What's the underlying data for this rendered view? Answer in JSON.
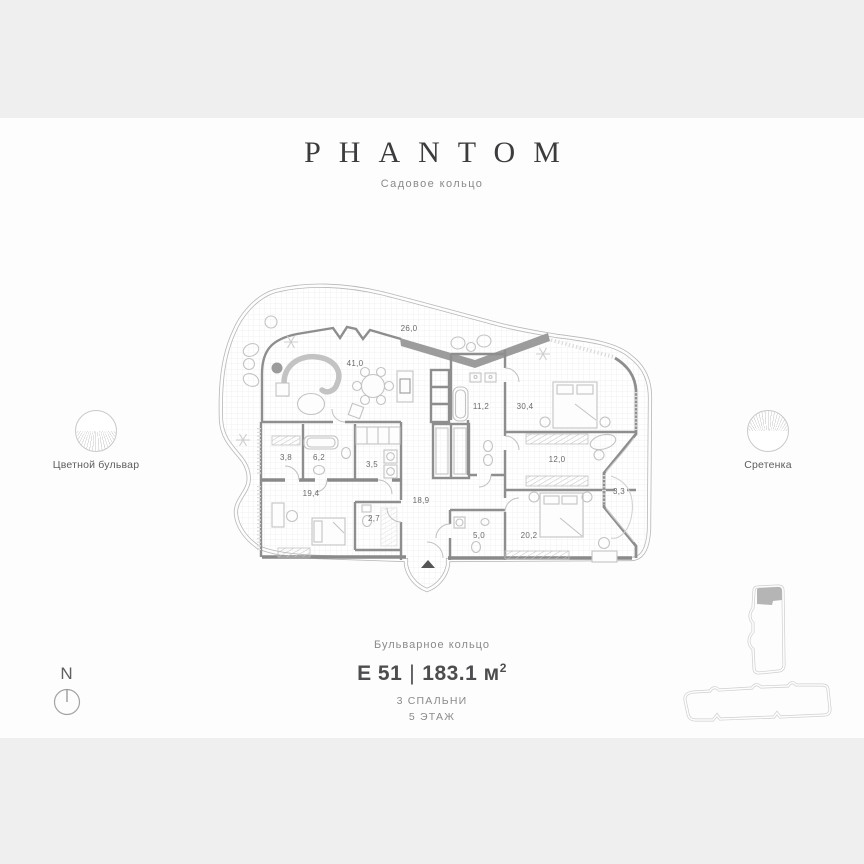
{
  "colors": {
    "background": "#efefef",
    "canvas": "#fdfdfd",
    "wall": "#8e8e8e",
    "text_dark": "#3c3c3e",
    "text_muted": "#8a8a8a"
  },
  "header": {
    "title": "PHANTOM",
    "subtitle": "Садовое кольцо"
  },
  "landmarks": {
    "left": {
      "label": "Цветной бульвар"
    },
    "right": {
      "label": "Сретенка"
    }
  },
  "footer": {
    "street": "Бульварное кольцо",
    "unit": "Е 51",
    "sep": "|",
    "area": "183.1",
    "area_unit": "м",
    "area_sup": "2",
    "bedrooms": "3 СПАЛЬНИ",
    "floor": "5 ЭТАЖ"
  },
  "compass": {
    "label": "N"
  },
  "floor_plan": {
    "total_area_m2": "183.1",
    "rooms": [
      {
        "name": "terrace",
        "area": "26,0",
        "x": 194,
        "y": 61
      },
      {
        "name": "living-room",
        "area": "41,0",
        "x": 140,
        "y": 96
      },
      {
        "name": "bathroom-main",
        "area": "11,2",
        "x": 266,
        "y": 139
      },
      {
        "name": "master-bedroom",
        "area": "30,4",
        "x": 310,
        "y": 139
      },
      {
        "name": "wardrobe-small",
        "area": "3,8",
        "x": 71,
        "y": 190
      },
      {
        "name": "bathroom-2",
        "area": "6,2",
        "x": 104,
        "y": 190
      },
      {
        "name": "laundry",
        "area": "3,5",
        "x": 157,
        "y": 197
      },
      {
        "name": "dressing-room",
        "area": "12,0",
        "x": 342,
        "y": 192
      },
      {
        "name": "bedroom-2",
        "area": "19,4",
        "x": 96,
        "y": 226
      },
      {
        "name": "hallway",
        "area": "18,9",
        "x": 206,
        "y": 233
      },
      {
        "name": "balcony",
        "area": "3,3",
        "x": 404,
        "y": 224
      },
      {
        "name": "bathroom-3",
        "area": "2,7",
        "x": 159,
        "y": 251
      },
      {
        "name": "bathroom-4",
        "area": "5,0",
        "x": 264,
        "y": 268
      },
      {
        "name": "bedroom-3",
        "area": "20,2",
        "x": 314,
        "y": 268
      }
    ]
  }
}
